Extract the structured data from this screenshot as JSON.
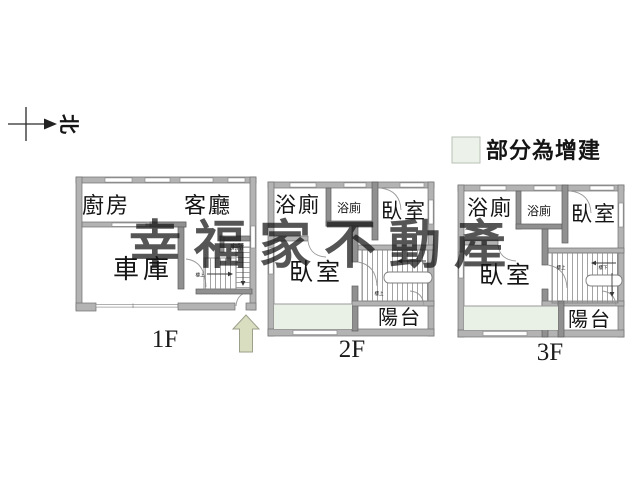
{
  "north": {
    "label": "北"
  },
  "legend": {
    "label": "部分為增建",
    "swatch_color": "#ecf2e9"
  },
  "watermark": {
    "text": "幸福家不動產",
    "color": "#7d8877"
  },
  "colors": {
    "addition_fill": "#e9f0e6",
    "arrow_fill": "#dadec1"
  },
  "floors": {
    "f1": {
      "label": "1F",
      "kitchen": "廚房",
      "living": "客廳",
      "garage": "車庫",
      "toilet": "廁所",
      "stairs_up": "樓上"
    },
    "f2": {
      "label": "2F",
      "bath": "浴廁",
      "bath_small": "浴廁",
      "bedroom_right": "臥室",
      "bedroom_main": "臥室",
      "balcony": "陽台",
      "stairs_up": "樓上"
    },
    "f3": {
      "label": "3F",
      "bath": "浴廁",
      "bath_small": "浴廁",
      "bedroom_right": "臥室",
      "bedroom_main": "臥室",
      "balcony": "陽台",
      "stairs_up": "樓上",
      "stairs_down": "樓下"
    }
  }
}
